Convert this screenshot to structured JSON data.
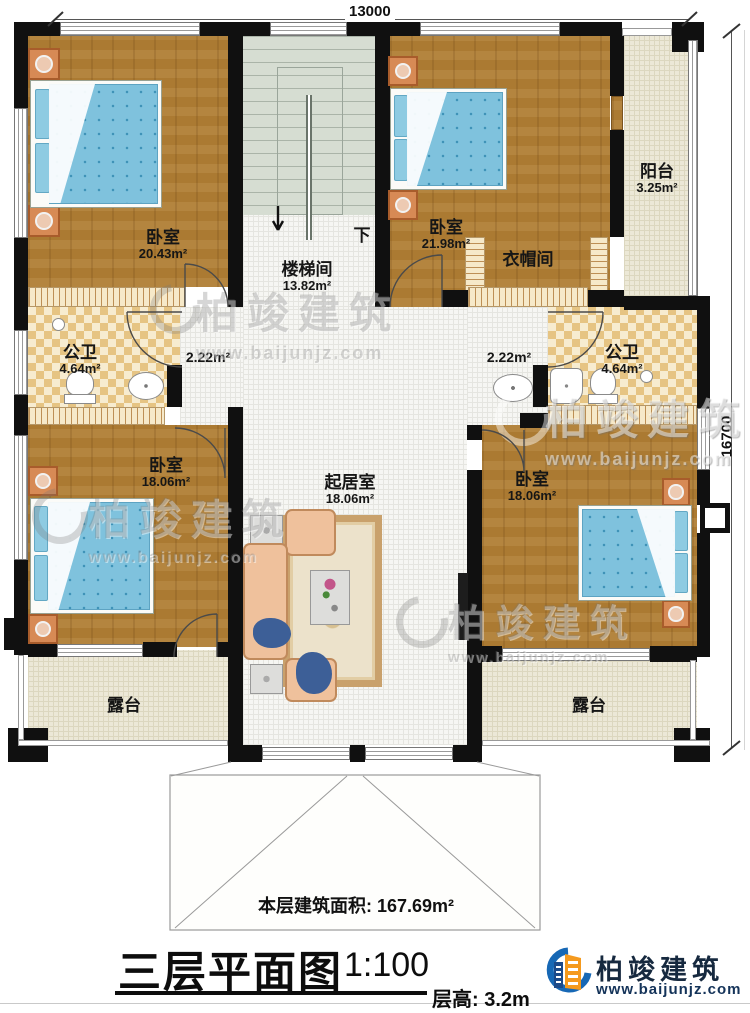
{
  "plan": {
    "dim_top": "13000",
    "dim_right": "16700",
    "rooms": {
      "bedroom_tl": {
        "name": "卧室",
        "area": "20.43m²"
      },
      "stairwell": {
        "name": "楼梯间",
        "area": "13.82m²",
        "direction": "下"
      },
      "bedroom_tr": {
        "name": "卧室",
        "area": "21.98m²"
      },
      "cloakroom": {
        "name": "衣帽间"
      },
      "balcony": {
        "name": "阳台",
        "area": "3.25m²"
      },
      "bath_left": {
        "name": "公卫",
        "area": "4.64m²"
      },
      "hall_left": {
        "area": "2.22m²"
      },
      "hall_right": {
        "area": "2.22m²"
      },
      "bath_right": {
        "name": "公卫",
        "area": "4.64m²"
      },
      "bedroom_bl": {
        "name": "卧室",
        "area": "18.06m²"
      },
      "living_room": {
        "name": "起居室",
        "area": "18.06m²"
      },
      "bedroom_br": {
        "name": "卧室",
        "area": "18.06m²"
      },
      "terrace_left": {
        "name": "露台"
      },
      "terrace_right": {
        "name": "露台"
      }
    },
    "floor_area": {
      "label": "本层建筑面积:",
      "value": "167.69m²"
    }
  },
  "footer": {
    "title": "三层平面图",
    "scale": "1:100",
    "floor_height_label": "层高:",
    "floor_height_value": "3.2m"
  },
  "brand": {
    "name": "柏竣建筑",
    "url": "www.baijunjz.com"
  },
  "watermark": {
    "name": "柏竣建筑",
    "url": "www.baijunjz.com"
  },
  "colors": {
    "wall": "#101010",
    "wood_floor": "#ab7a32",
    "mattress_blue": "#7fc2dd",
    "bath_checker": "#e6c483",
    "stair_green": "#d6ddd2",
    "terrace_cream": "#ece8d7",
    "logo_blue": "#1768b5",
    "logo_orange": "#f59a1e"
  }
}
